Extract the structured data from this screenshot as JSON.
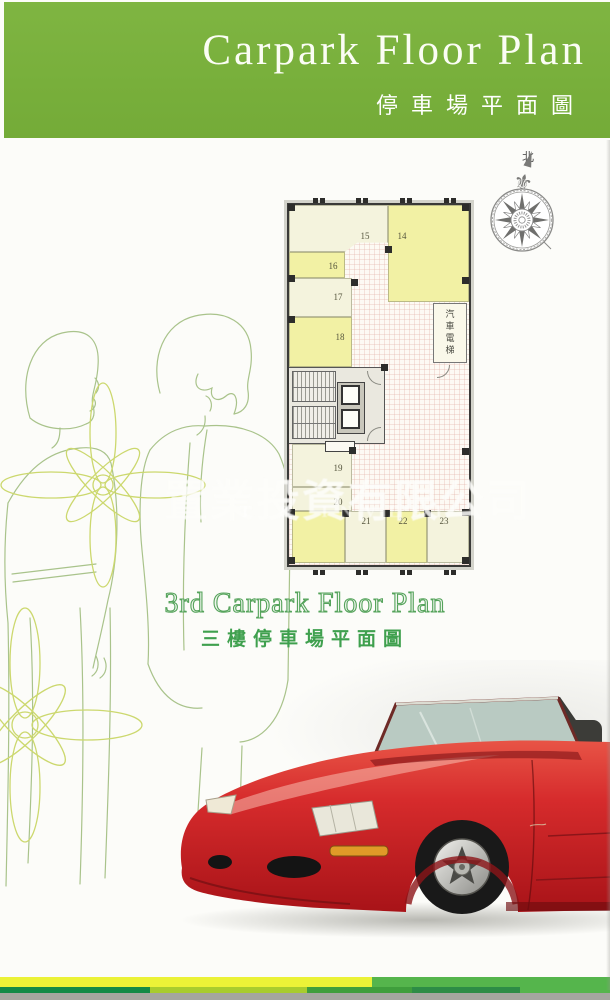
{
  "header": {
    "title_en": "Carpark Floor Plan",
    "subtitle_zh": "停車場平面圖"
  },
  "compass": {
    "north_label": "北"
  },
  "floor_plan": {
    "elevator_label": "汽車電梯",
    "space_labels": {
      "s14": "14",
      "s15": "15",
      "s16": "16",
      "s17": "17",
      "s18": "18",
      "s19": "19",
      "s20": "20",
      "s21": "21",
      "s22": "22",
      "s23": "23"
    }
  },
  "caption": {
    "title_en": "3rd Carpark Floor Plan",
    "subtitle_zh": "三樓停車場平面圖"
  },
  "watermark": {
    "line1": "置業投資有限公司",
    "line2": "T & INVEST"
  },
  "colors": {
    "header_green": "#78af3b",
    "caption_green": "#3fa04e",
    "stripe_yellow": "#ebf237",
    "stripe_green": "#55b54c",
    "space_cream": "#f4f3dd",
    "space_yellow": "#f2f1a4",
    "car_red": "#cc2127"
  }
}
